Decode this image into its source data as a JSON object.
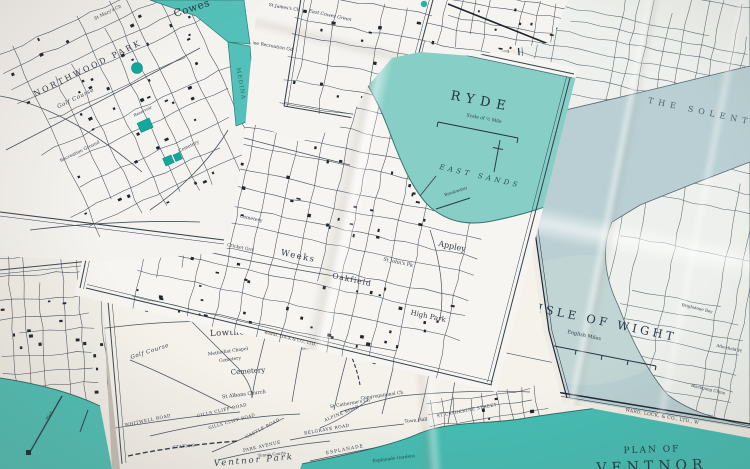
{
  "colors": {
    "harbor_teal": "#53c1b9",
    "ryde_sea_teal": "#86cec6",
    "ventnor_sea_teal": "#44bcb3",
    "seafront_sea_teal": "#4dbfb6",
    "solent_grey_blue": "#b9cfd3",
    "reservoir_teal": "#12a89c",
    "map_ink": "#47525e",
    "title_ink": "#21333f",
    "paper": "#f5f3ef"
  },
  "sheets": {
    "cowes": {
      "town": "Cowes",
      "park": "NORTHWOOD PARK",
      "golf_course": "Golf Course",
      "church": "St Mary's Ch",
      "recreation": "Recreation Ground",
      "cemetery": "Cemetery",
      "reservoir": "Reservoir",
      "river": "MEDINA"
    },
    "east_cowes": {
      "church": "St James's Ch",
      "green": "East Cowes Green",
      "recreation": "Jubilee Recreation Gd"
    },
    "ryde": {
      "title": "RYDE",
      "scale": "Scale of ½ Mile",
      "east_sands": "EAST SANDS",
      "weeks": "Weeks",
      "oakfield": "Oakfield",
      "appley": "Appley",
      "high_park": "High Park",
      "st_johns": "St John's Pk",
      "cemetery": "Cemetery",
      "cricket": "Cricket Grd",
      "breakwater": "Breakwater",
      "imprint": "WARD, LOCK & CO., LTD."
    },
    "isle_of_wight": {
      "title": "THE ISLE OF WIGHT",
      "scale": "English Miles",
      "solent": "THE SOLENT",
      "brighstone": "Brighstone Bay",
      "atherfield": "Atherfield Pt",
      "blackgang": "Blackgang Chine",
      "imprint": "WARD, LOCK, & CO., LTD., W"
    },
    "seafront": {
      "pier": "Pier"
    },
    "ventnor": {
      "plan_of": "PLAN OF",
      "title": "VENTNOR",
      "lowtherville": "Lowtherville",
      "methodist_chapel": "Methodist Chapel",
      "cemetery_small": "Cemetery",
      "cemetery": "Cemetery",
      "reservoir": "Reservoir",
      "row_farm": "Row Farm",
      "golf_course": "Golf Course",
      "whitwell_road": "WHITWELL ROAD",
      "gills_cliff_road": "GILLS CLIFF ROAD",
      "castle_road": "CASTLE ROAD",
      "park_avenue": "PARK AVENUE",
      "ventnor_park": "Ventnor Park",
      "tennis_courts": "Tennis Courts",
      "belgrave_road": "BELGRAVE ROAD",
      "alpine_road": "ALPINE ROAD",
      "st_albans": "St Albans Church",
      "st_catherines": "St Catherine's Ch",
      "congregational": "Congregational Ch",
      "town_hall": "Town Hall",
      "st_catherine_street": "ST CATHERINE STREET",
      "esplanade": "ESPLANADE",
      "esplanade_gardens": "Esplanade Gardens",
      "station": "STATION",
      "ventnor_station": "Ventnor Sta."
    }
  }
}
